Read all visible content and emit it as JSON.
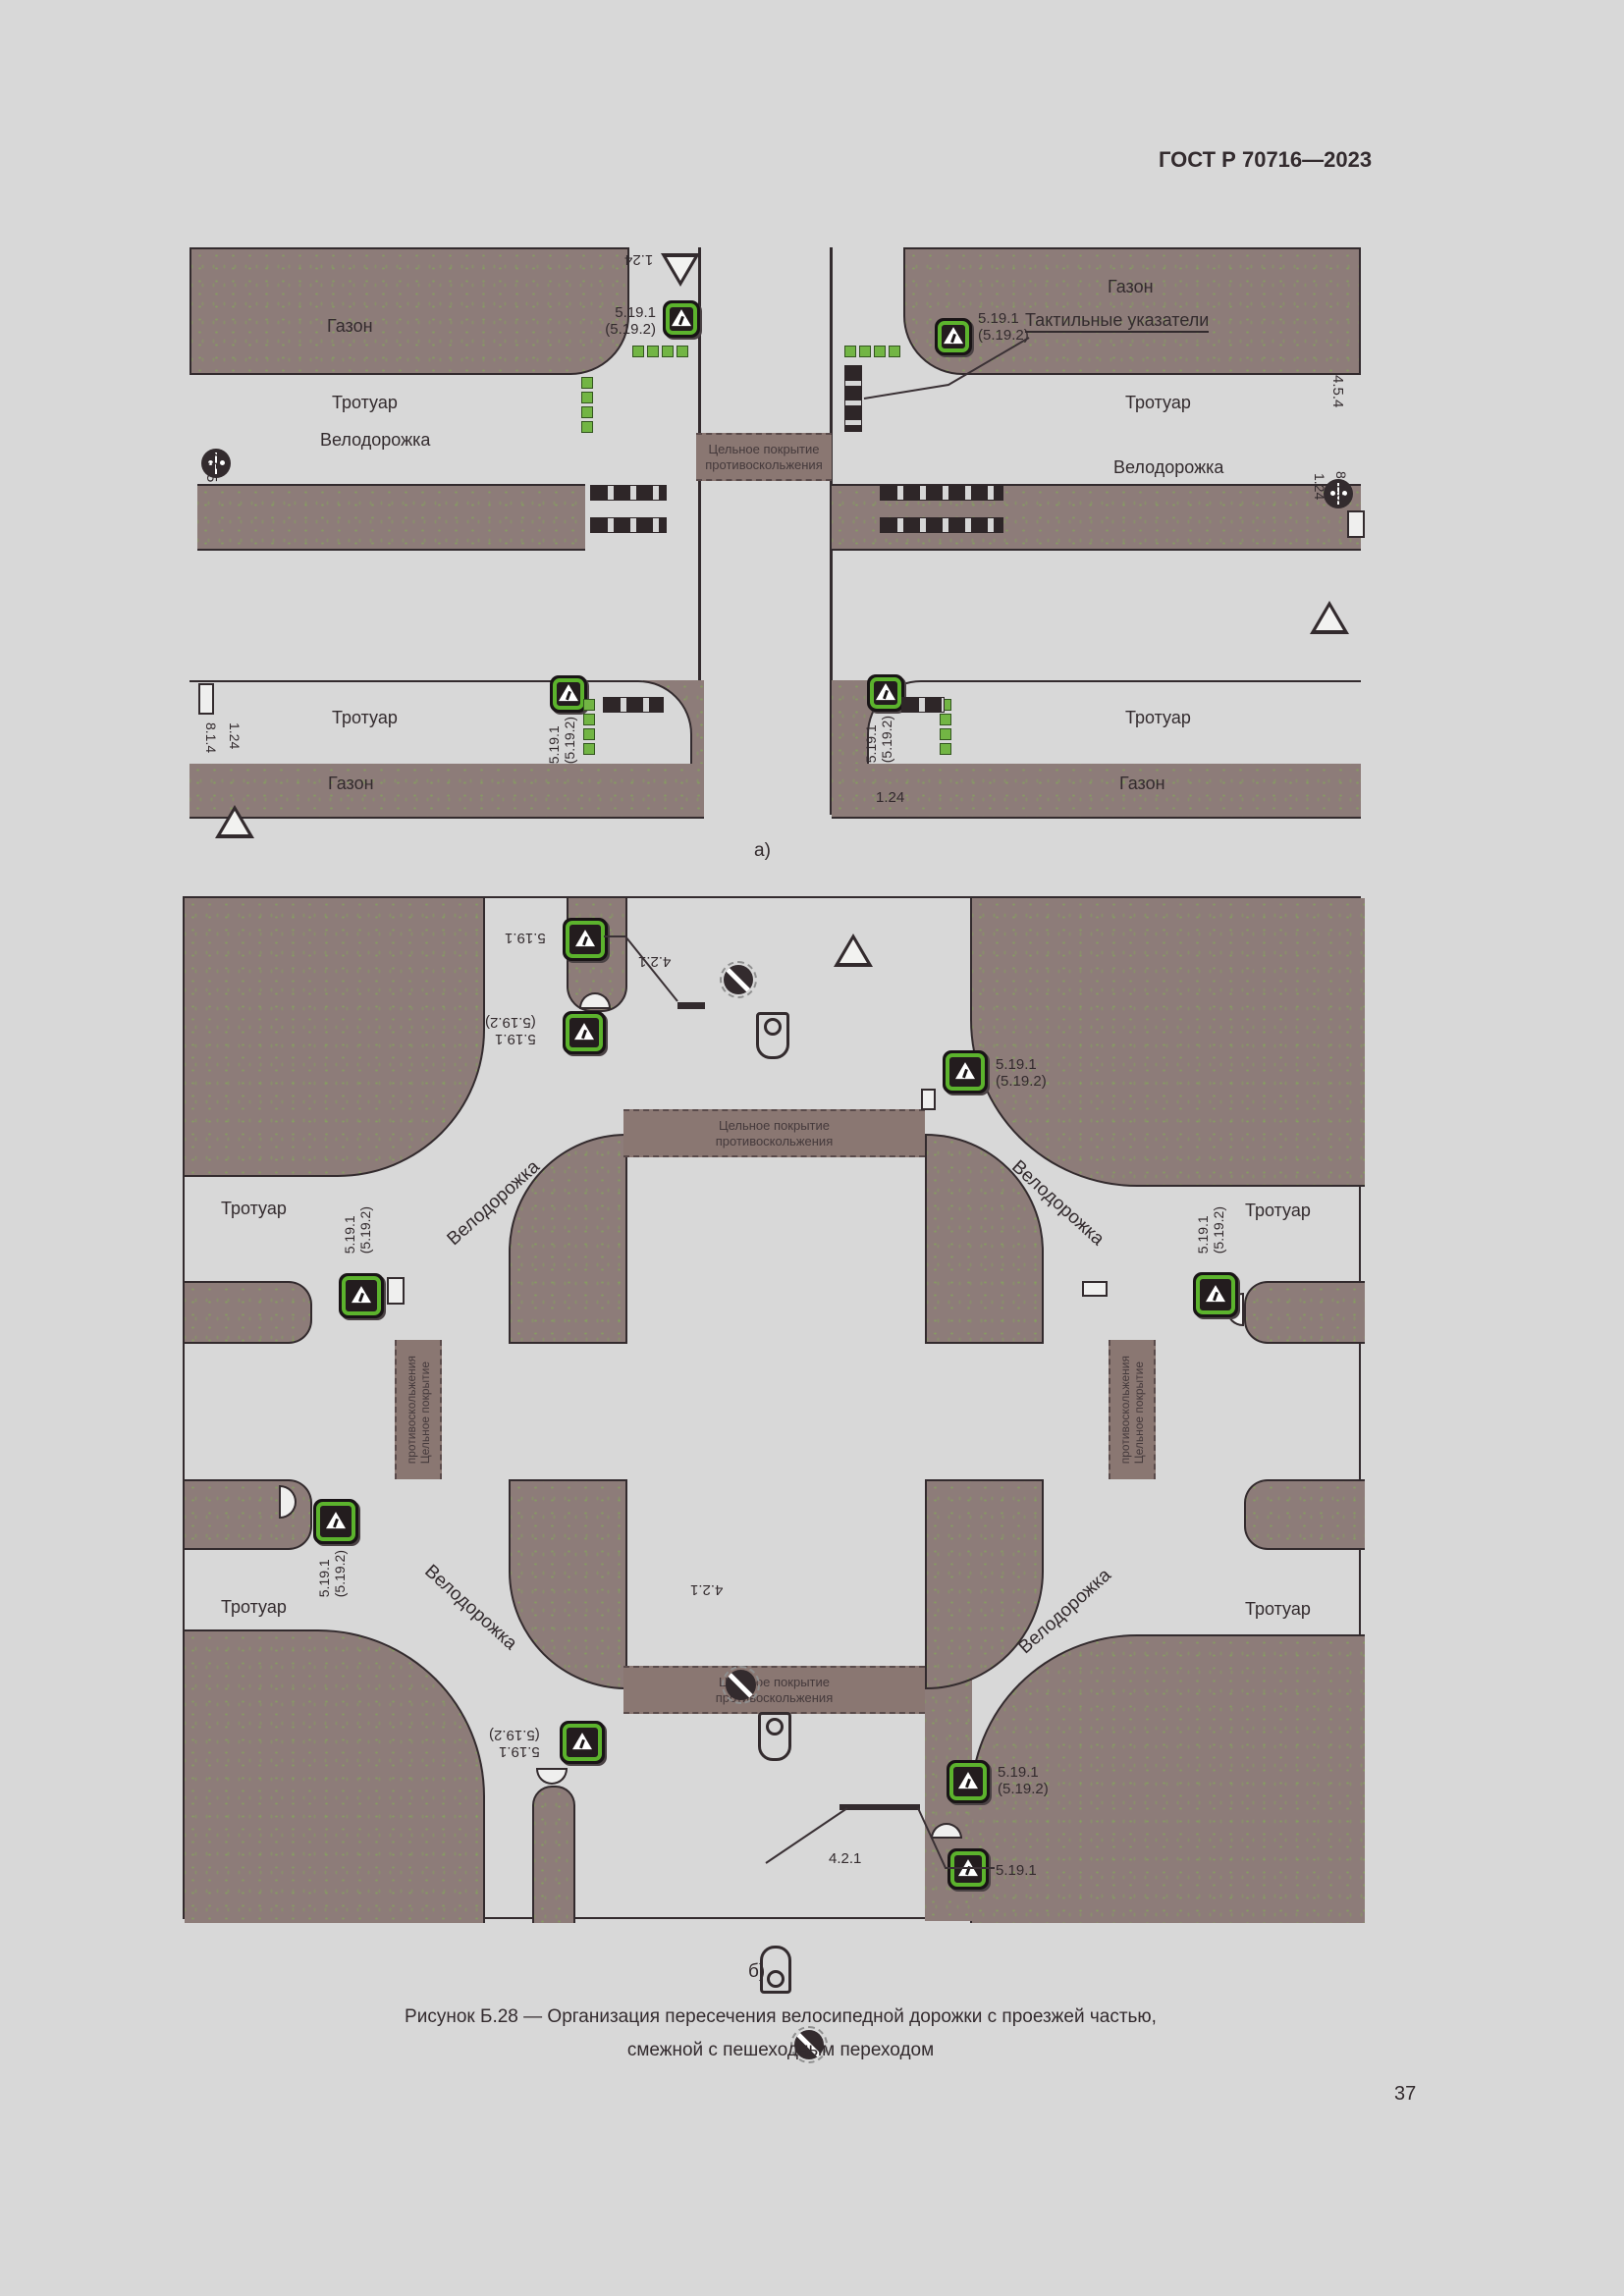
{
  "page": {
    "header": "ГОСТ Р 70716—2023",
    "page_number": "37",
    "figure_a_label": "а)",
    "figure_b_label": "б)",
    "caption_line1": "Рисунок Б.28 — Организация пересечения велосипедной дорожки с проезжей частью,",
    "caption_line2": "смежной с пешеходным переходом"
  },
  "labels": {
    "lawn": "Газон",
    "sidewalk": "Тротуар",
    "bike_path": "Велодорожка",
    "tactile": "Тактильные указатели",
    "coating_line1": "Цельное покрытие",
    "coating_line2": "противоскольжения"
  },
  "signs": {
    "ped_crossing": "5.19.1",
    "ped_crossing_alt": "(5.19.2)",
    "bike_crossing_warning": "1.24",
    "plate_8_1_4": "8.1.4",
    "plate_8_1_3": "8.1.3",
    "ped_bike_path_1": "4.5.5",
    "ped_bike_path_2": "4.5.4",
    "bike_path_round": "4.2.1"
  }
}
